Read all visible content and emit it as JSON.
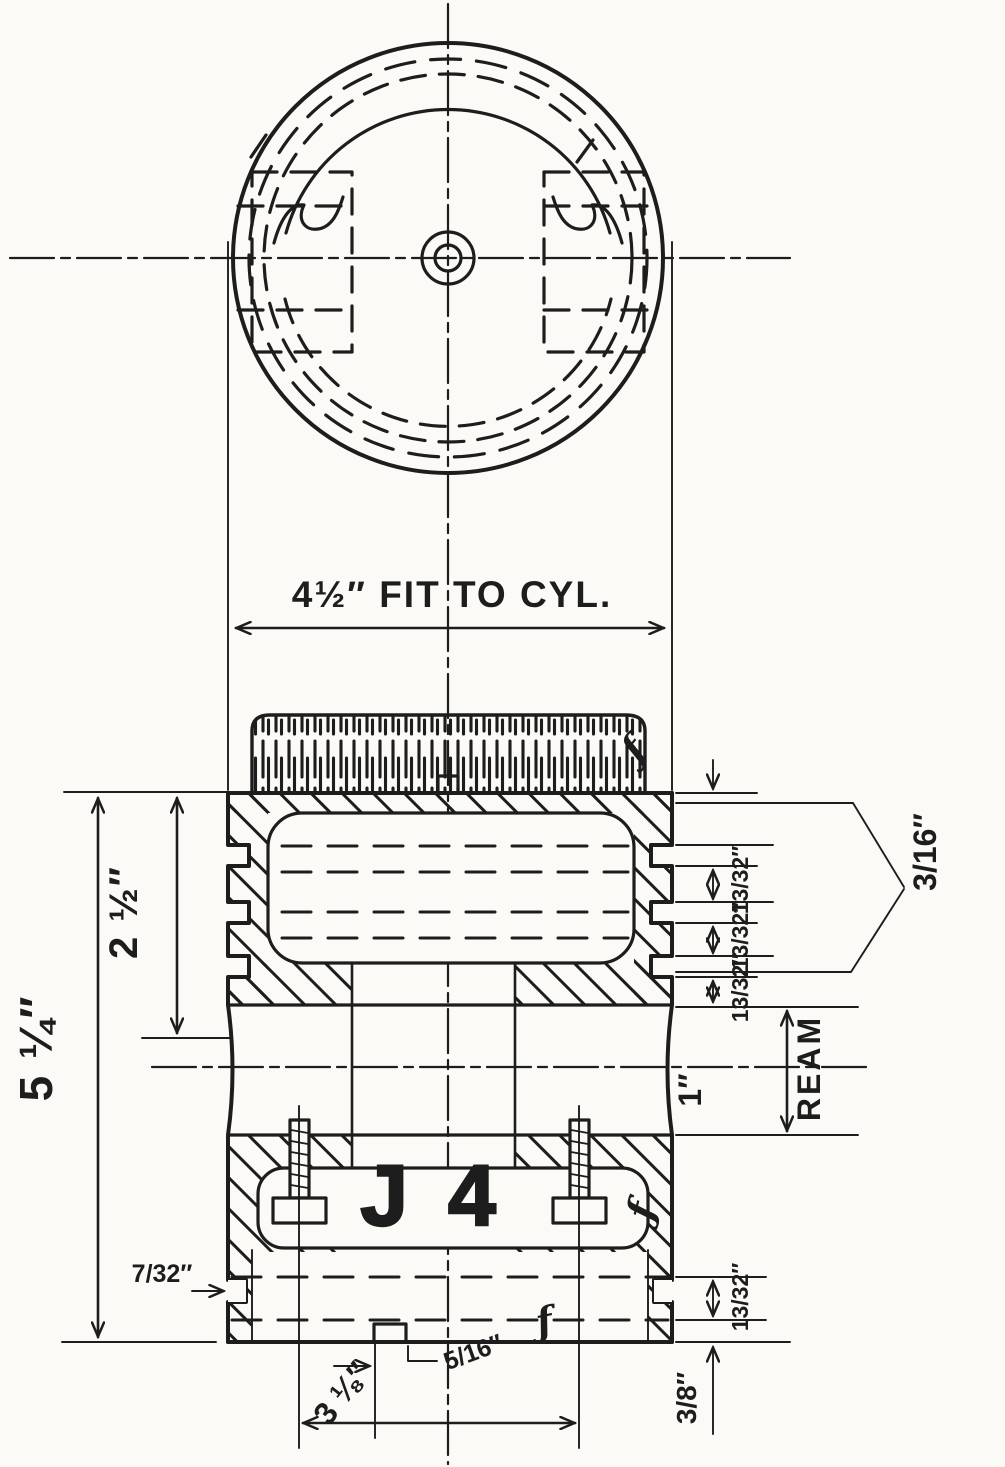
{
  "labels": {
    "fit_to_cyl": "4½″ FIT TO CYL.",
    "overall_height": "5 ¼″",
    "upper_height": "2 ½″",
    "ring_width": "3/16″",
    "ring_land": "13/32″",
    "pin_bore": "1″",
    "ream": "REAM",
    "skirt_groove_width": "7/32″",
    "skirt_land": "13/32″",
    "base_offset": "3/8″",
    "screw_spacing": "3 ⅛″",
    "vent_width": "5/16″",
    "part_mark": "J 4",
    "finish_mark": "ƒ"
  },
  "colors": {
    "ink": "#1d1d1d",
    "paper": "#fbfaf6"
  }
}
